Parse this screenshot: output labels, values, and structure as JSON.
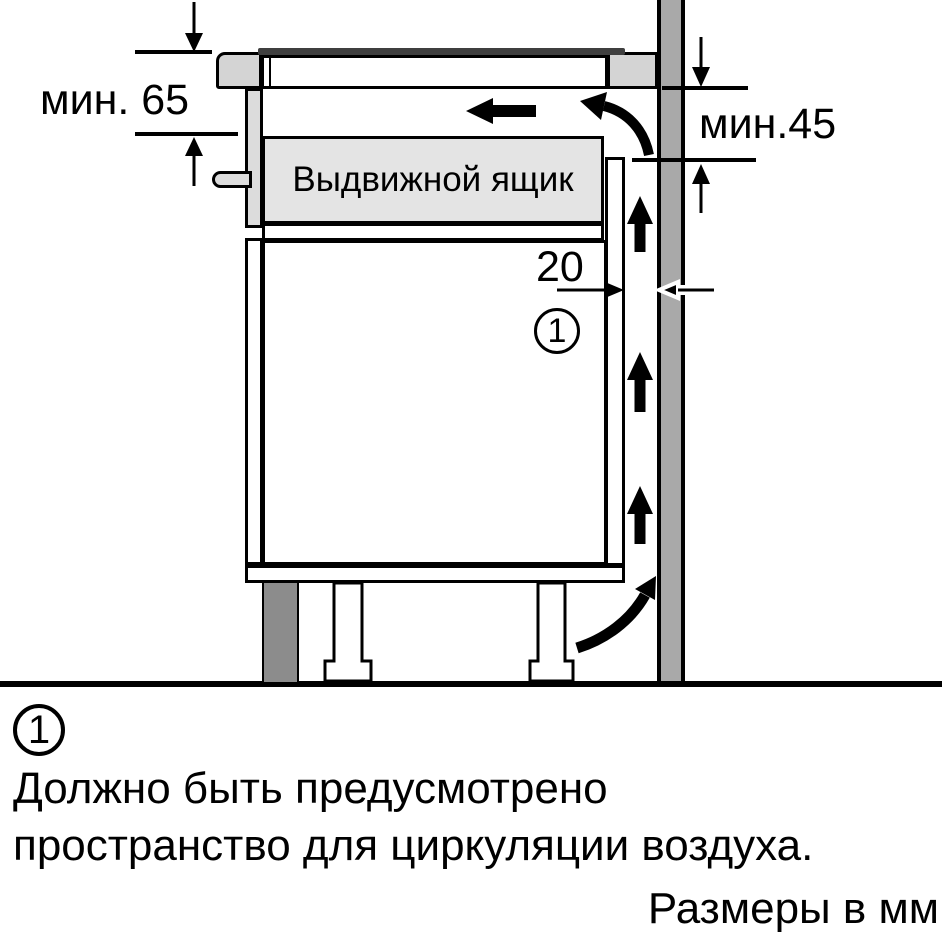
{
  "diagram": {
    "drawer_label": "Выдвижной ящик",
    "dimensions": {
      "worktop_to_drawer_min": "мин. 65",
      "vent_gap_min": "мин.45",
      "rear_gap": "20"
    },
    "callout_number": "1",
    "colors": {
      "wall": "#a9a9a9",
      "plinth": "#8c8c8c",
      "worktop_section": "#d4d4d4",
      "drawer_fill": "#e4e4e4",
      "hob_glass": "#3f3f3f",
      "outline": "#000000"
    }
  },
  "footnote": {
    "number": "1",
    "line1": "Должно быть предусмотрено",
    "line2": "пространство для циркуляции воздуха."
  },
  "units_caption": "Размеры в мм"
}
